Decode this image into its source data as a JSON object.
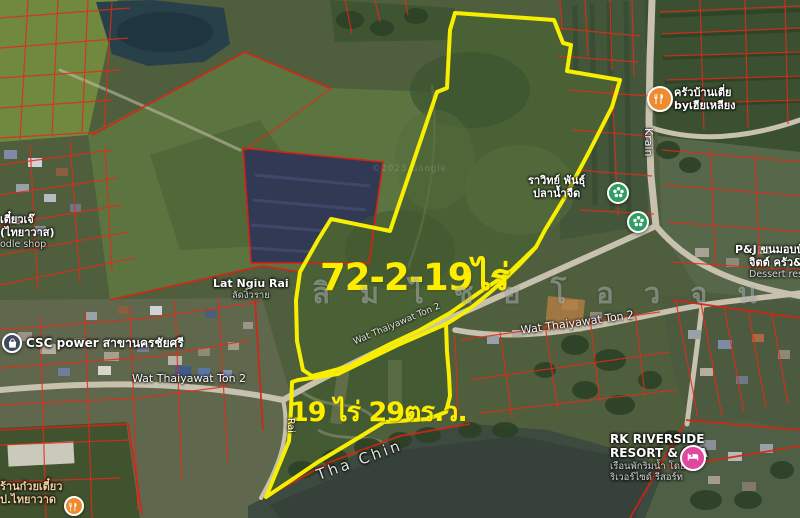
{
  "map": {
    "area_labels": {
      "upper_parcel": "72-2-19ไร่",
      "lower_parcel": "19 ไร่ 29ตร.ว."
    },
    "watermark": "ลิ ม ไ ช ย โ อ ว จ น",
    "imagery_credit": "©2023 Google",
    "river_label": "Tha Chin",
    "road_labels": {
      "krain": "Krain",
      "rai": "Rai",
      "wat_thaiyawat_diagonal": "Wat Thaiyawat Ton 2",
      "wat_thaiyawat_horizontal": "Wat Thaiyawat Ton 2",
      "wat_thaiyawat_on_road": "Wat Thaiyawat Ton 2"
    },
    "places": {
      "noodle_shop_topleft": {
        "line1": "เตี๋ยวเจ๊",
        "line2": "(ไทยาวาส)",
        "line3": "odle shop"
      },
      "csc_power": {
        "label": "CSC power สาขานครชัยศรี"
      },
      "lat_ngiu_rai": {
        "line1": "Lat Ngiu Rai",
        "line2": "ลัดงิ้วราย"
      },
      "fish_farm": {
        "line1": "ราวิทย์ พันธุ์",
        "line2": "ปลาน้ำจืด"
      },
      "krua_baan_tia": {
        "line1": "ครัวบ้านเตี่ย",
        "line2": "byเฮียเหลียง"
      },
      "pj_dessert": {
        "line1": "P&J ขนมอบบ้",
        "line2": "จิตต์ ครัว&",
        "line3": "Dessert resta"
      },
      "rk_riverside": {
        "line1": "RK RIVERSIDE",
        "line2": "RESORT & SPA",
        "line3": "เรือนพักริมน้ำ โดย",
        "line4": "ริเวอร์ไซด์ รีสอร์ท"
      },
      "noodle_shop_bottomleft": {
        "line1": "ร้านก๋วยเตี๋ยว",
        "line2": "ป.ไทยาวาด"
      }
    },
    "colors": {
      "parcel_outline": "#f8ef00",
      "cadastral_line": "#e12b18",
      "restaurant_marker": "#ef8b2e",
      "attraction_marker": "#2e9e63",
      "hotel_marker": "#e0479e",
      "store_marker": "#3e4a5e"
    }
  }
}
